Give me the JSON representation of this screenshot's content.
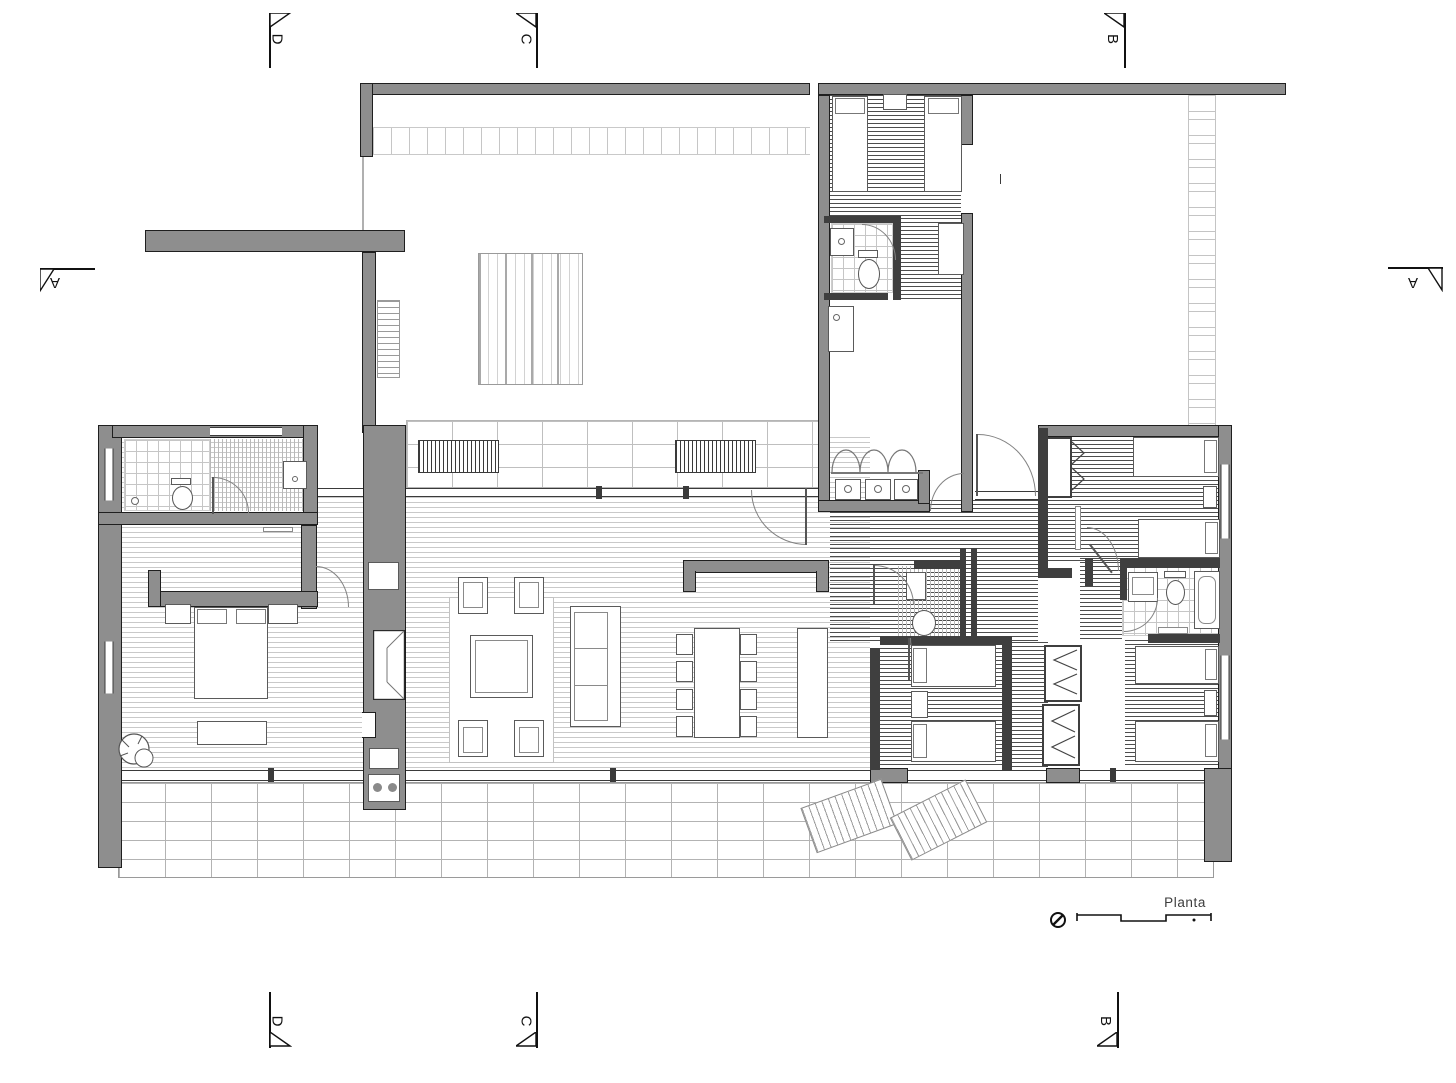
{
  "plan": {
    "title": "Planta"
  },
  "markers": {
    "d_top": "D",
    "c_top": "C",
    "b_top": "B",
    "d_bottom": "D",
    "c_bottom": "C",
    "b_bottom": "B",
    "a_left": "A",
    "a_right": "A"
  },
  "icons": {
    "north": "north-indicator",
    "scale": "graphic-scale-bar",
    "section_flag": "section-cut-flag"
  },
  "colors": {
    "paper": "#ffffff",
    "exterior_wall": "#8e8e8e",
    "partition_wall": "#3f3f3f",
    "outline": "#1f1f1f",
    "floor_line_light": "#c9c9c9",
    "floor_line_dark": "#4d4d4d",
    "tile_line": "#bfbfbf"
  }
}
